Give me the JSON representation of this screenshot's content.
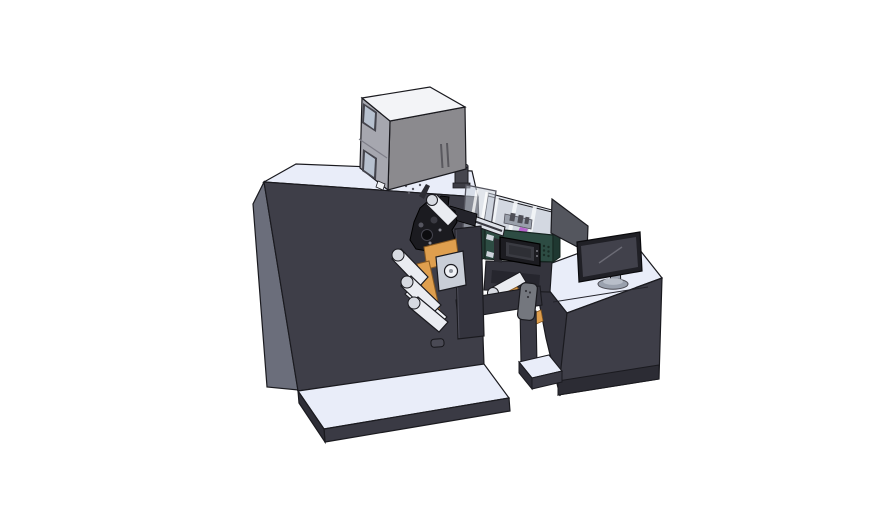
{
  "scene": {
    "description": "isometric 3d cad render of a roll-fed label printing machine with unwind rollers, an open-lid process module with hmi touch panel, and an operator desk with monitor",
    "background": "#ffffff"
  },
  "parts": {
    "main_cabinet": "main machine cabinet",
    "base_platform": "machine base platform",
    "top_unit": "electronics enclosure on top",
    "vent_cylinder": "exhaust cylinder",
    "web_mechanism": "web guide mechanism",
    "unwind_rollers": "unwind roller cascade",
    "orange_plates": "mounting plates",
    "process_module": "open process module with clear lid",
    "hmi_panel": "hmi touch panel",
    "operator_desk": "operator desk",
    "monitor": "desktop monitor",
    "side_panel": "tilted guard panel",
    "sensor_unit": "sensor unit on beam"
  },
  "colors": {
    "outline": "#1a1a1f",
    "cabinet_front": "#3e3e48",
    "cabinet_side": "#6b6e7b",
    "surface_light": "#e9edf9",
    "platform_edge": "#3a3a44",
    "platform_edge_dark": "#2e2e37",
    "box_top": "#f3f4f7",
    "box_left": "#a6a7af",
    "box_front": "#8b8a8e",
    "window_frame": "#44444c",
    "window_glass": "#b7c1cf",
    "vent_body": "#46464e",
    "vent_top": "#73737d",
    "mech_dark": "#1b1b20",
    "mech_mid": "#2c2c33",
    "rail_light": "#dde1e8",
    "plate_dark": "#34343e",
    "orange": "#df9f4e",
    "orange_edge": "#8a5a20",
    "roller": "#eaecf1",
    "roller_cap": "#d7dae1",
    "panel_light": "#c9ced7",
    "white_part": "#f0f2f6",
    "teal_front": "#2d4c43",
    "teal_side": "#223b34",
    "teal_right": "#1f3831",
    "interior_floor": "#d3d8e1",
    "interior_wall": "#e4e8ef",
    "lid_glass": "rgba(200,208,218,0.55)",
    "purple_part": "#b666cc",
    "gray_part": "#9aa0ab",
    "hmi_bezel": "#1c1c21",
    "hmi_screen": "#3a3b42",
    "hmi_screen_dark": "#2e2f35",
    "support_dark": "#34343d",
    "beam_dark": "#35353e",
    "leg_dark": "#3a3a44",
    "sensor_gray": "#74777e",
    "desk_front": "#3e3e48",
    "desk_side": "#34343e",
    "desk_plinth": "#2c2c34",
    "monitor_bezel": "#202026",
    "monitor_screen": "#41414b",
    "stand_gray": "#9aa1ae",
    "stand_top": "#b8bec9",
    "side_panel": "#54565e"
  }
}
